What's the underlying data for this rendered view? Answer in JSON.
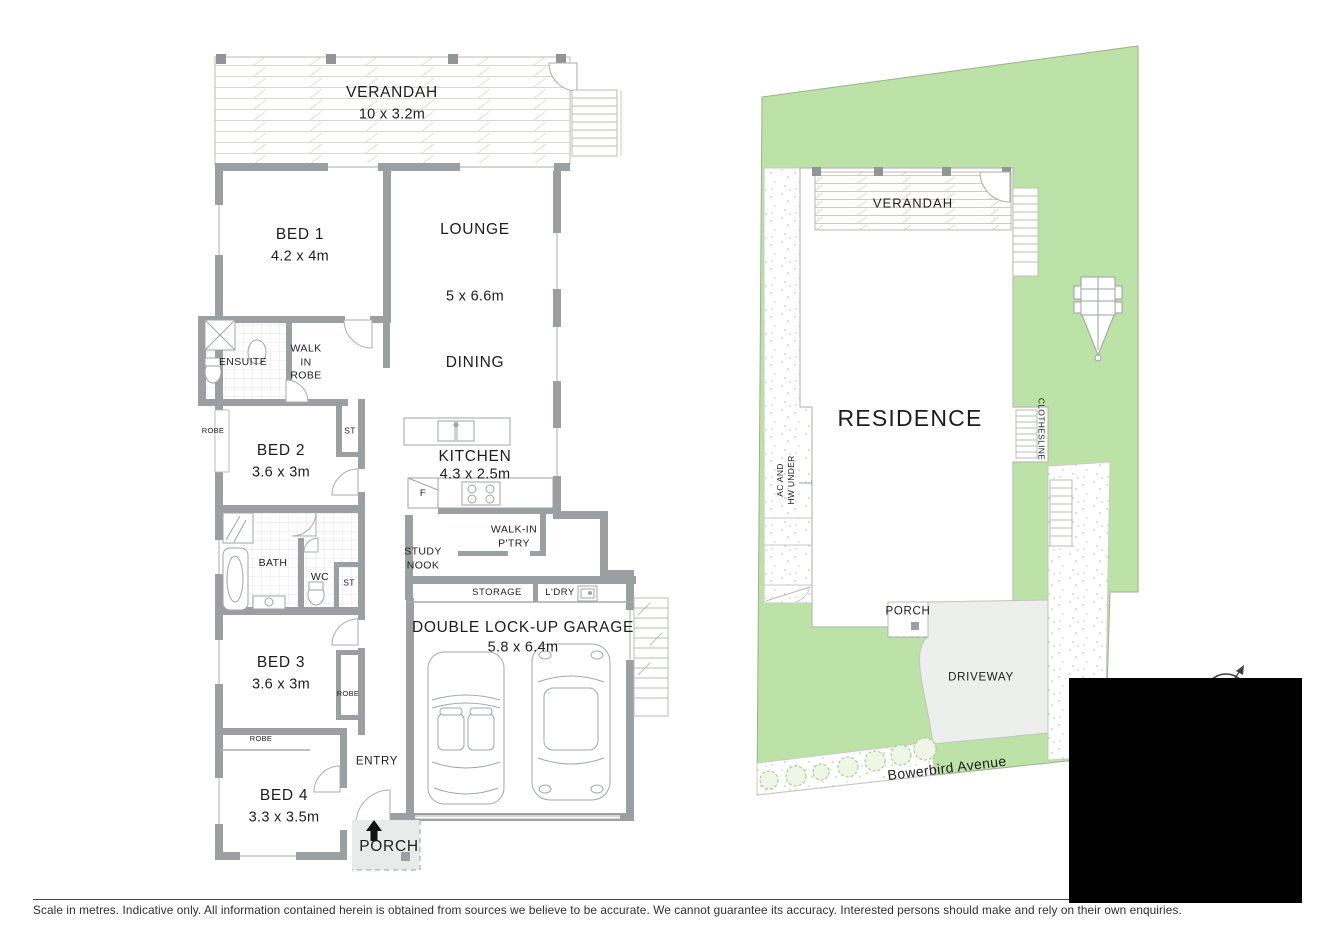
{
  "colors": {
    "lawn": "#bde2a7",
    "wall": "#9aa0a2",
    "driveway": "#ecefec",
    "porch_fill": "#e9ebea",
    "redaction": "#000000"
  },
  "floor_plan": {
    "verandah": {
      "name": "VERANDAH",
      "dims": "10 x 3.2m"
    },
    "bed1": {
      "name": "BED 1",
      "dims": "4.2 x 4m"
    },
    "lounge": {
      "name": "LOUNGE",
      "dims": "5 x 6.6m"
    },
    "dining": {
      "name": "DINING"
    },
    "ensuite": {
      "name": "ENSUITE"
    },
    "walk_in_robe": {
      "name": "WALK\nIN\nROBE"
    },
    "robe_bed2": {
      "name": "ROBE"
    },
    "bed2": {
      "name": "BED 2",
      "dims": "3.6 x 3m"
    },
    "st_upper": {
      "name": "ST"
    },
    "kitchen": {
      "name": "KITCHEN",
      "dims": "4.3 x 2.5m"
    },
    "fridge": {
      "name": "F"
    },
    "walk_in_pantry": {
      "name": "WALK-IN\nP'TRY"
    },
    "study_nook": {
      "name": "STUDY\nNOOK"
    },
    "bath": {
      "name": "BATH"
    },
    "wc": {
      "name": "WC"
    },
    "st_lower": {
      "name": "ST"
    },
    "storage": {
      "name": "STORAGE"
    },
    "laundry": {
      "name": "L'DRY"
    },
    "garage": {
      "name": "DOUBLE LOCK-UP GARAGE",
      "dims": "5.8 x 6.4m"
    },
    "bed3": {
      "name": "BED 3",
      "dims": "3.6 x 3m"
    },
    "robe_bed3": {
      "name": "ROBE"
    },
    "robe_bed4": {
      "name": "ROBE"
    },
    "entry": {
      "name": "ENTRY"
    },
    "bed4": {
      "name": "BED 4",
      "dims": "3.3 x 3.5m"
    },
    "porch": {
      "name": "PORCH"
    }
  },
  "site_plan": {
    "verandah": {
      "name": "VERANDAH"
    },
    "residence": {
      "name": "RESIDENCE"
    },
    "clothesline": {
      "name": "CLOTHESLINE"
    },
    "ac_hw": {
      "name": "AC AND\nHW UNDER"
    },
    "porch": {
      "name": "PORCH"
    },
    "driveway": {
      "name": "DRIVEWAY"
    },
    "street": {
      "name": "Bowerbird Avenue"
    }
  },
  "footer": {
    "disclaimer": "Scale in metres. Indicative only. All information contained herein is obtained from sources we believe to be accurate. We cannot guarantee its accuracy. Interested persons should make and rely on their own enquiries."
  }
}
